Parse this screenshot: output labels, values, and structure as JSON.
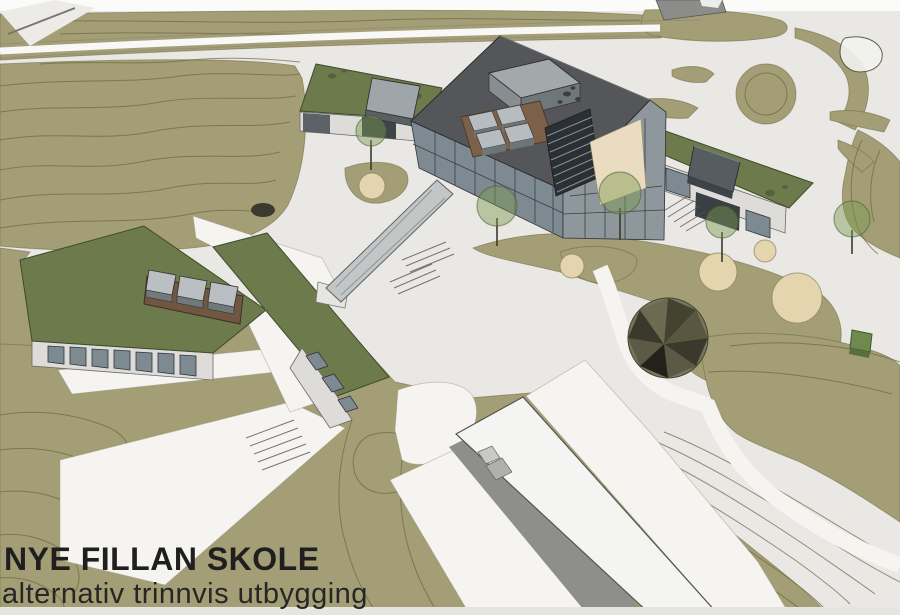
{
  "title": {
    "line1": "NYE FILLAN SKOLE",
    "line2": "alternativ trinnvis utbygging"
  },
  "colors": {
    "terrain": "#a49e76",
    "contour": "#6b673f",
    "road": "#e9e8e4",
    "path": "#f5f4f1",
    "roof-green": "#6d7a4b",
    "roof-dark": "#55565a",
    "glass": "#7e8a92",
    "mullion": "#2e3134",
    "penthouse": "#a3a8aa",
    "wood": "#7c6148",
    "sand": "#e5d5ae",
    "tree": "#7d9a52",
    "tree-edge": "#4c5c33",
    "building-white": "#f4f4f2",
    "shadow": "#8e8e8c",
    "text": "#1f1f1f"
  }
}
